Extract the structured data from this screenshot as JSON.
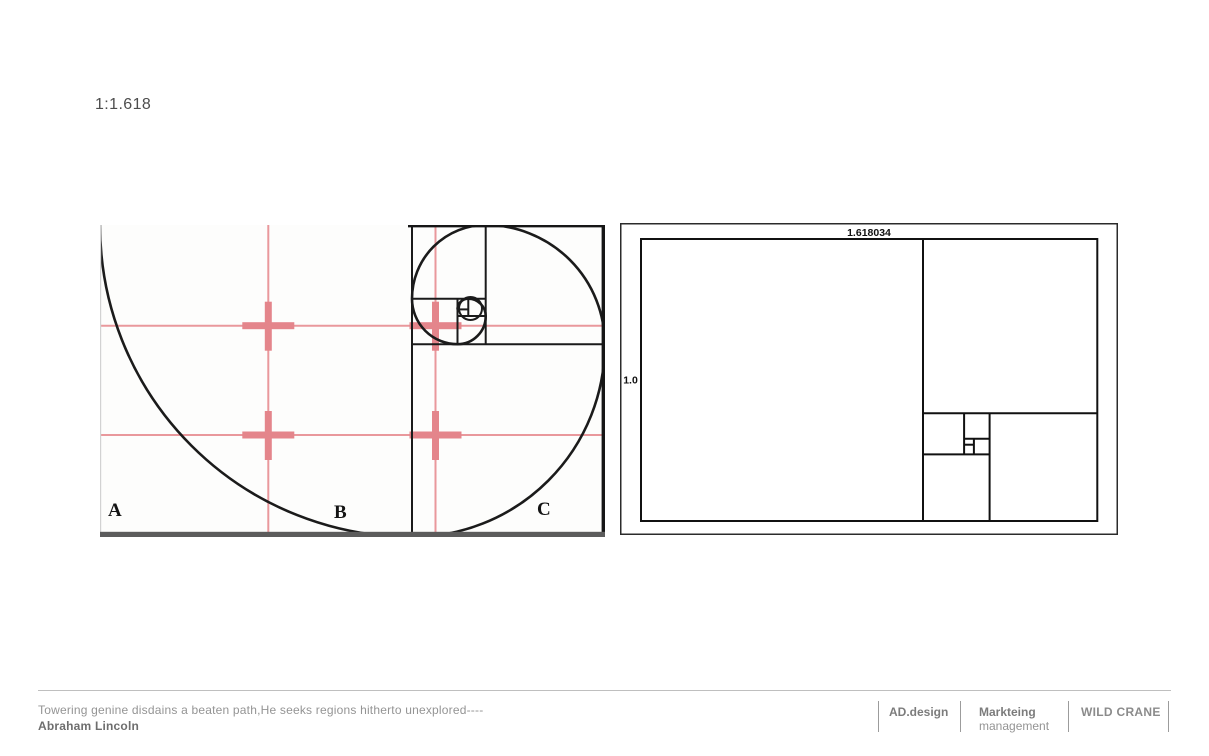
{
  "title": "1:1.618",
  "left_figure": {
    "description": "golden spiral construction with rule-of-thirds grid overlay",
    "section_labels": [
      "A",
      "B",
      "C"
    ],
    "colors": {
      "spiral_line": "#1b1b1b",
      "grid_pink": "#e9989c",
      "cross_pink": "#e4858b",
      "bottom_edge_gray": "#5c5c5c"
    }
  },
  "right_figure": {
    "description": "golden rectangle recursive subdivision",
    "top_label": "1.618034",
    "side_label": "1.0",
    "line_color": "#111111"
  },
  "footer": {
    "quote": "Towering genine disdains a beaten path,He seeks regions hitherto unexplored----",
    "author": "Abraham Lincoln",
    "brands": [
      {
        "name": "AD.design"
      },
      {
        "name": "Markteing",
        "subtitle": "management"
      },
      {
        "name": "WILD CRANE"
      }
    ]
  }
}
